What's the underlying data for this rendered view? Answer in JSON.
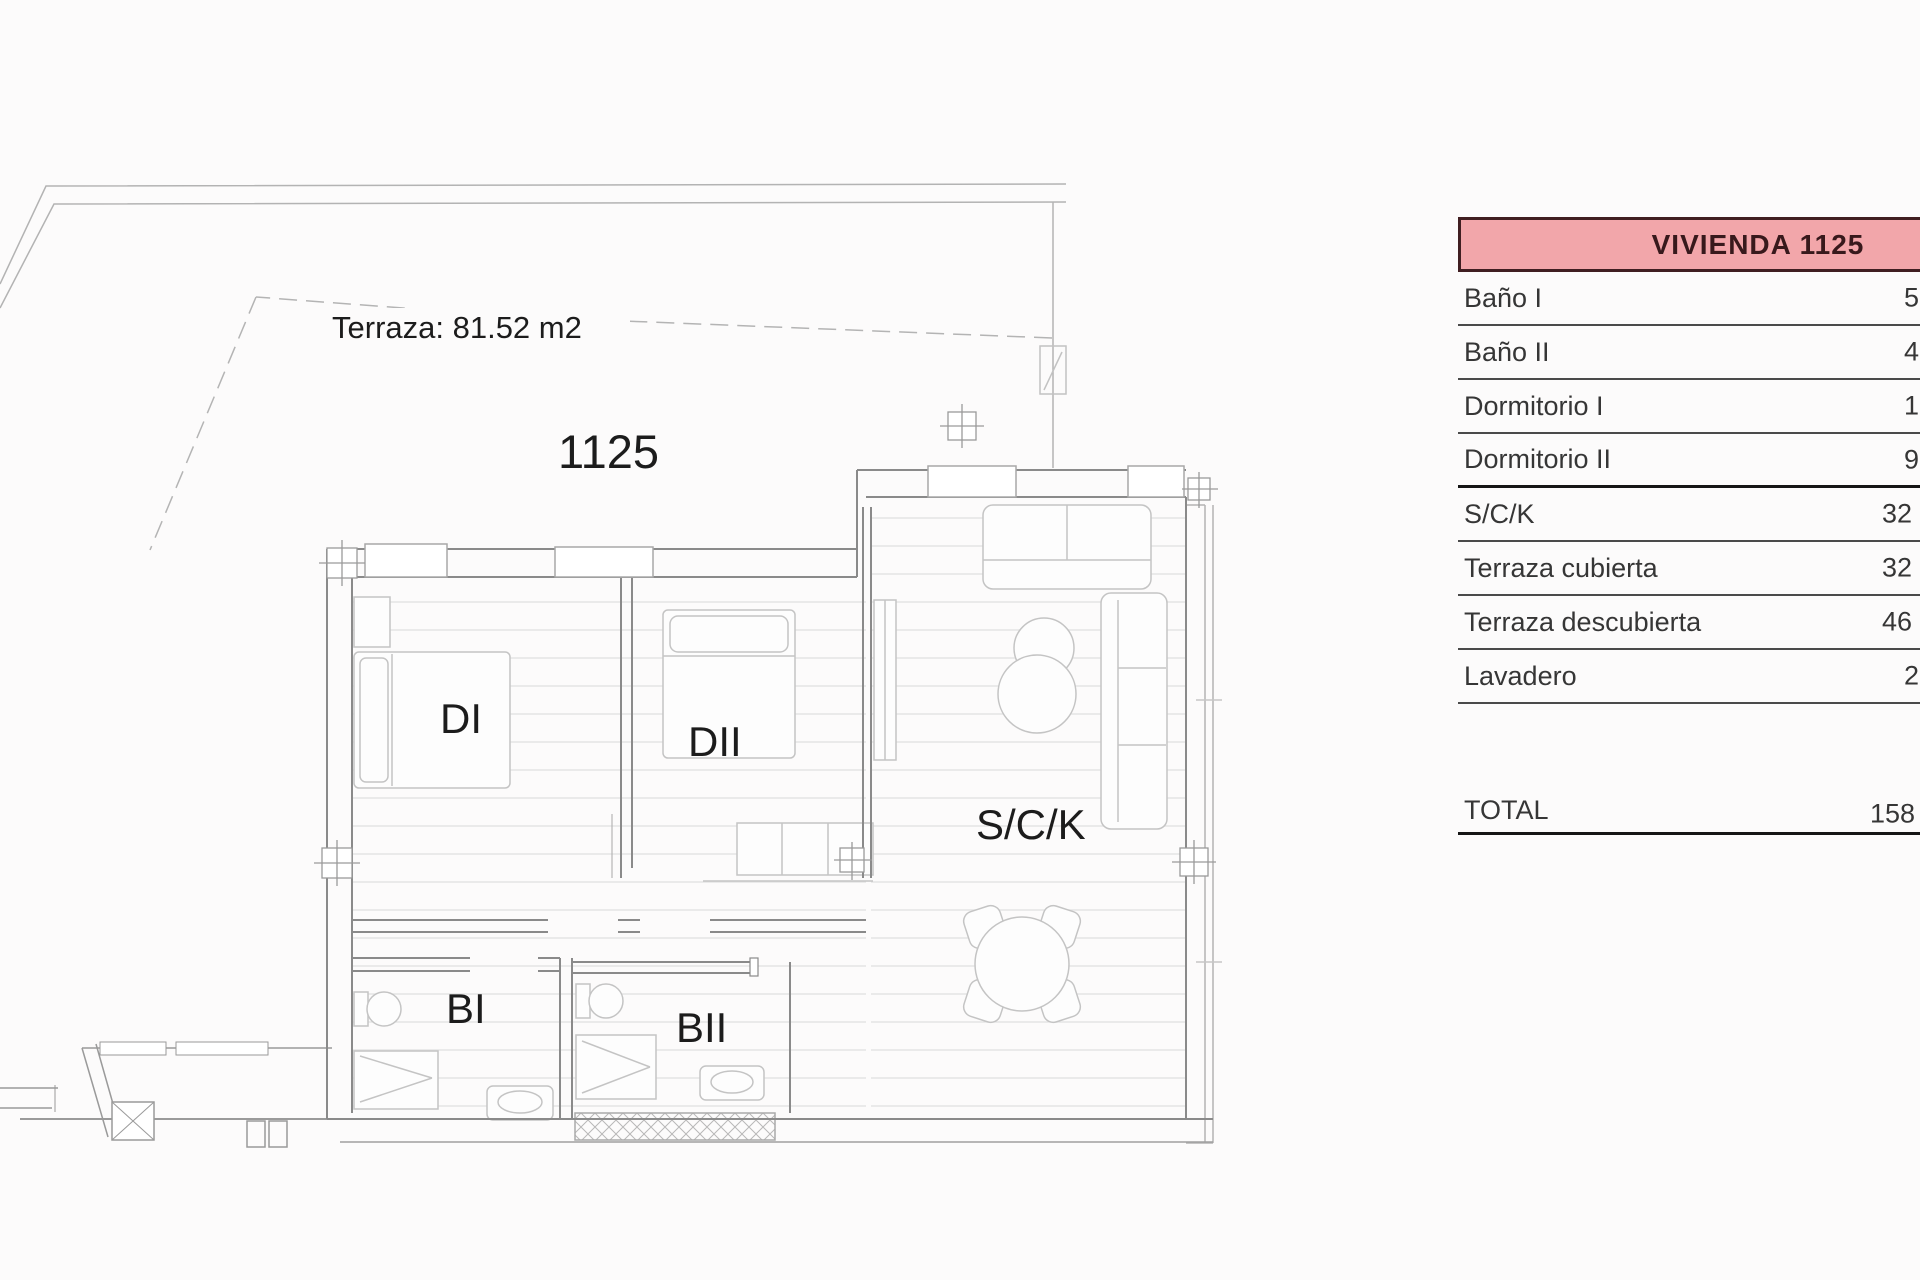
{
  "page": {
    "background": "#fcfbfb"
  },
  "plan": {
    "terrace_note": "Terraza: 81.52 m2",
    "unit_number": "1125",
    "unit_number_color": "#b23a36",
    "rooms": {
      "dormitorio1": "DI",
      "dormitorio2": "DII",
      "salon": "S/C/K",
      "bano1": "BI",
      "bano2": "BII"
    }
  },
  "table": {
    "header": "VIVIENDA 1125",
    "header_bg": "#f2a6aa",
    "header_border": "#401e21",
    "rows": [
      {
        "label": "Baño I",
        "value": "5"
      },
      {
        "label": "Baño II",
        "value": "4"
      },
      {
        "label": "Dormitorio I",
        "value": "1"
      },
      {
        "label": "Dormitorio II",
        "value": "9"
      },
      {
        "label": "S/C/K",
        "value": "32"
      },
      {
        "label": "Terraza cubierta",
        "value": "32"
      },
      {
        "label": "Terraza descubierta",
        "value": "46"
      },
      {
        "label": "Lavadero",
        "value": "2"
      }
    ],
    "total": {
      "label": "TOTAL",
      "value": "158"
    }
  }
}
